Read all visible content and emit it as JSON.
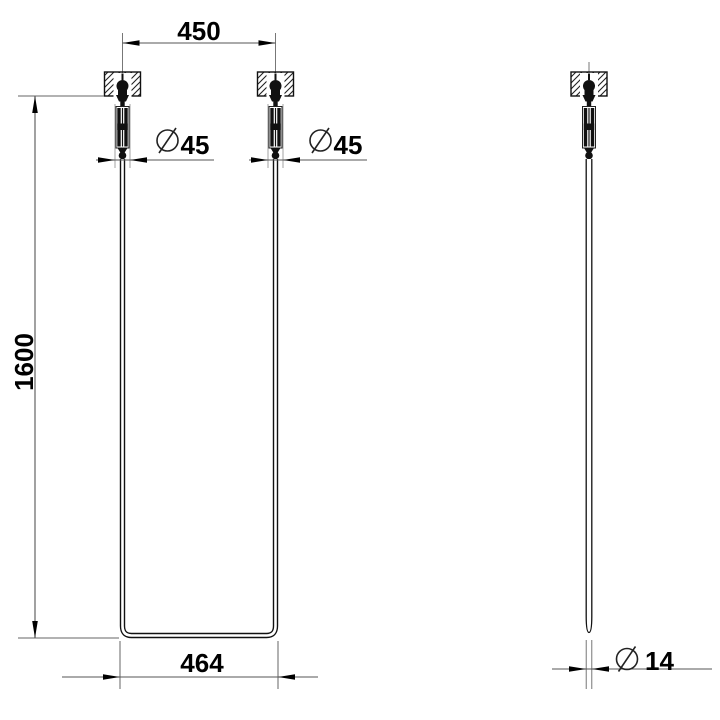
{
  "drawing": {
    "type": "technical-drawing",
    "views": {
      "front": {
        "dimensions": {
          "top_width": "450",
          "height": "1600",
          "bottom_width": "464",
          "left_hanger_diameter": "45",
          "right_hanger_diameter": "45"
        }
      },
      "side": {
        "dimensions": {
          "rod_diameter": "14"
        }
      }
    },
    "diameter_symbol": "Ø",
    "colors": {
      "background": "#ffffff",
      "object_line": "#111111",
      "dimension_line": "#555555",
      "extension_line": "#666666",
      "centerline": "#777777",
      "hatch_line": "#222222",
      "text": "#000000"
    }
  }
}
